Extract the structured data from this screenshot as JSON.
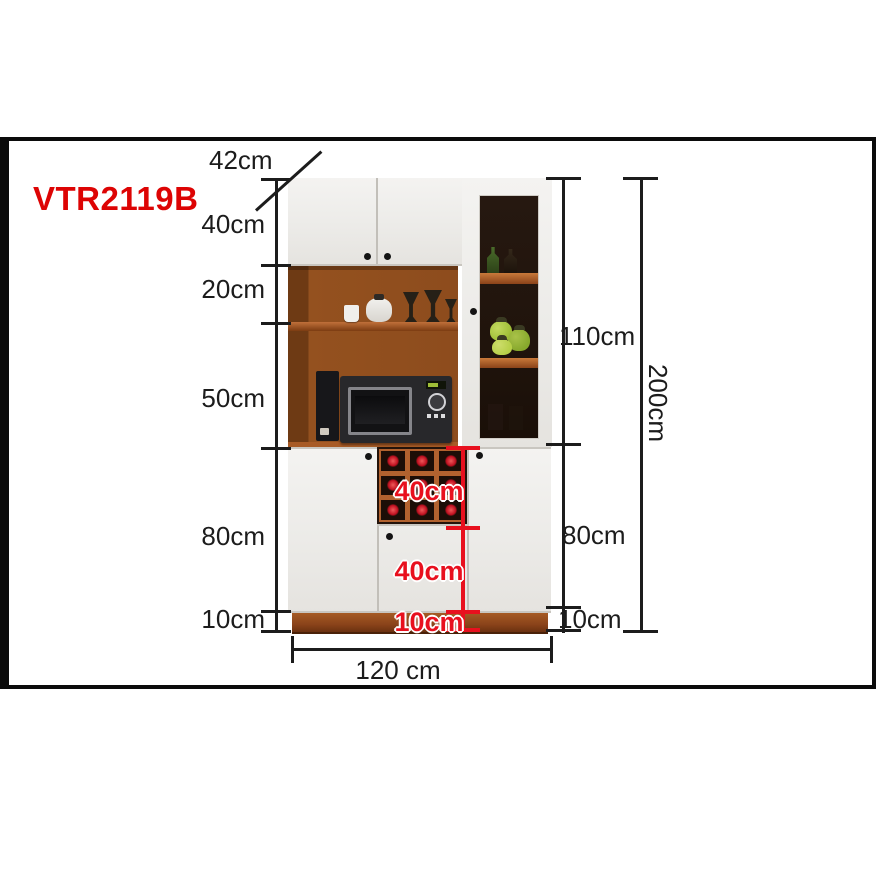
{
  "product": {
    "model": "VTR2119B"
  },
  "dimensions": {
    "depth": "42cm",
    "left_heights": [
      "40cm",
      "20cm",
      "50cm",
      "80cm",
      "10cm"
    ],
    "right_heights": [
      "110cm",
      "80cm",
      "10cm"
    ],
    "total_height": "200cm",
    "width": "120 cm",
    "inner_red": [
      "40cm",
      "40cm",
      "10cm"
    ]
  },
  "colors": {
    "accent-red": "#dd0404",
    "red-dim": "#e8101e",
    "line": "#1c1c1c",
    "wood": "#94511f",
    "wood-dark": "#6e3a14",
    "wood-light": "#b2622f",
    "plinth": "#8a431a",
    "door-white": "#f0efec",
    "glass-bg": "#20140c",
    "green-item": "#9fbe37"
  }
}
